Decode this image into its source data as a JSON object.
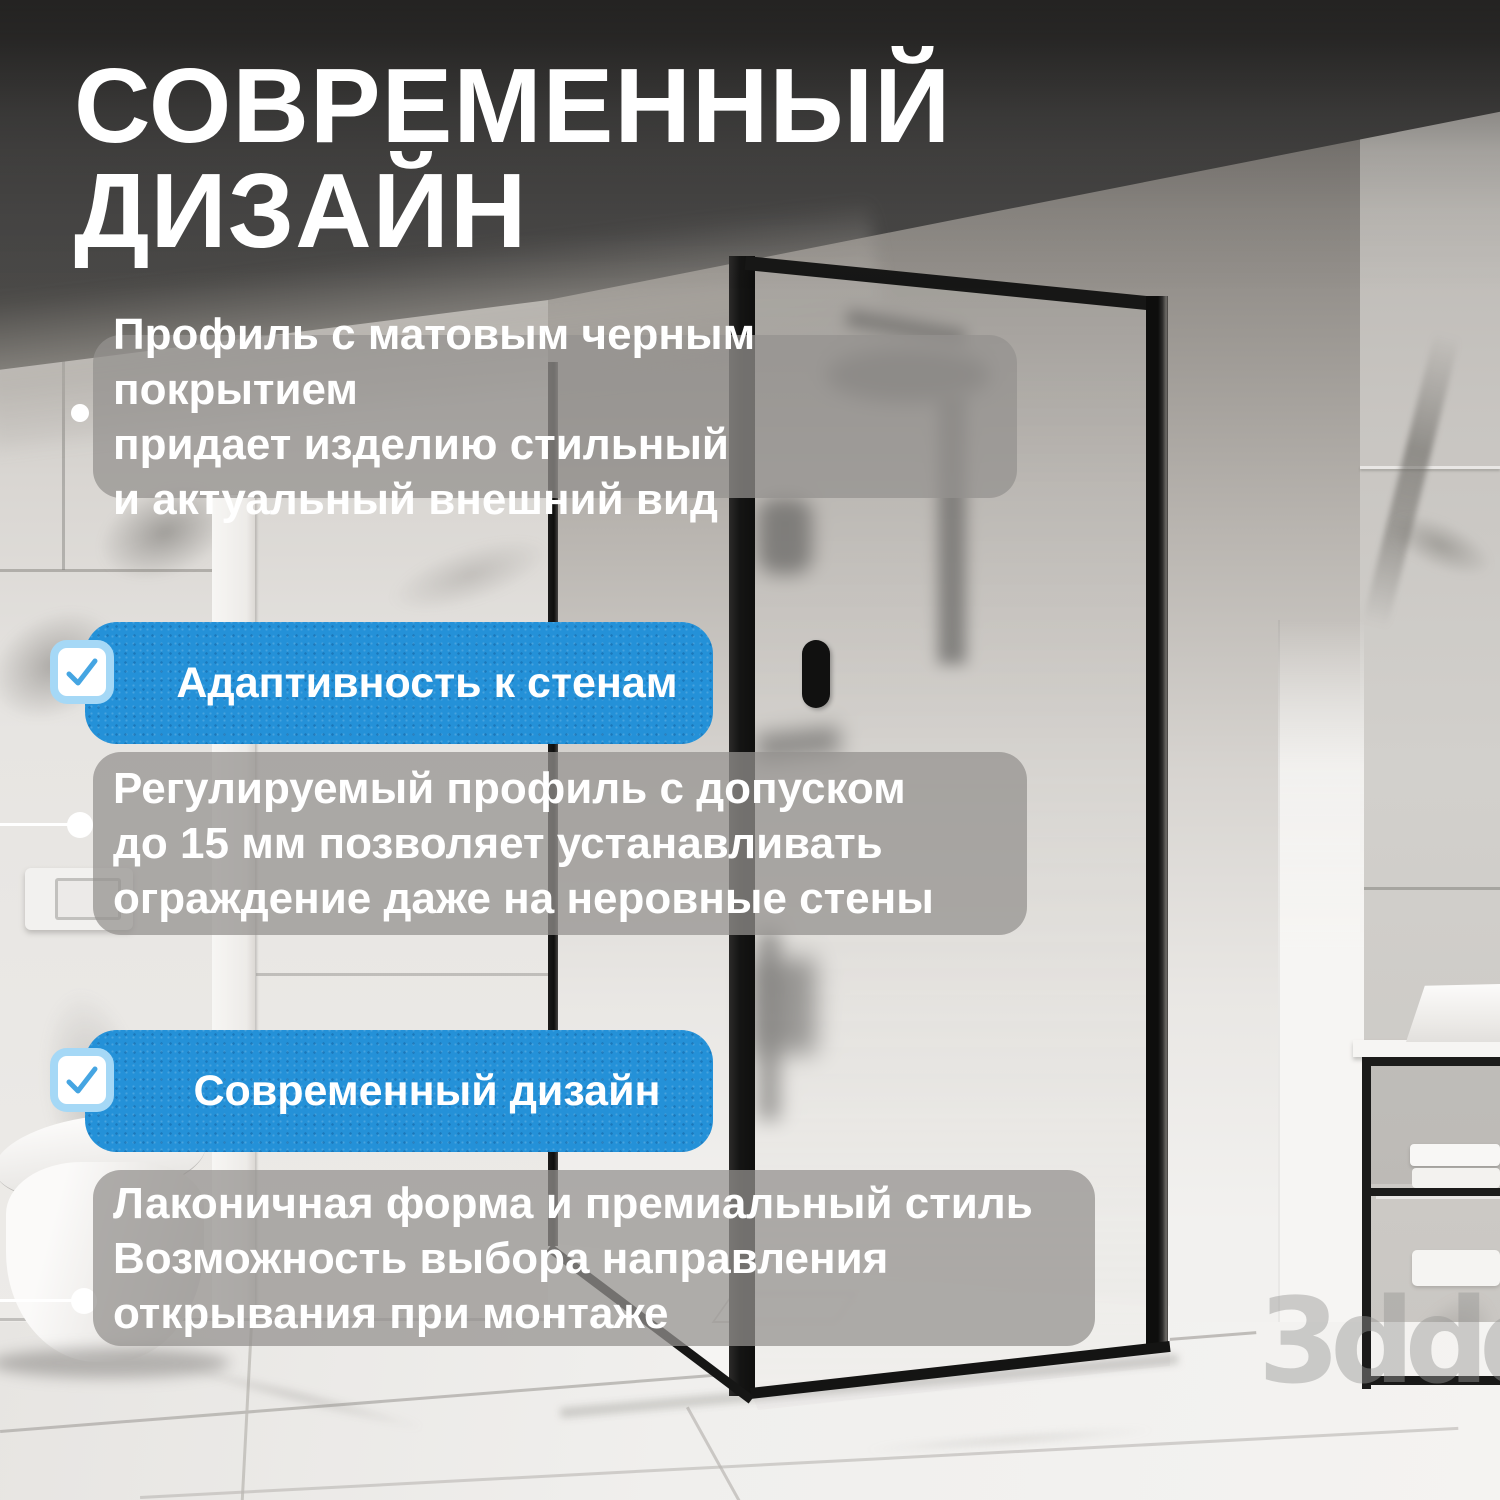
{
  "title": {
    "line1": "СОВРЕМЕННЫЙ",
    "line2": "ДИЗАЙН"
  },
  "features": [
    {
      "lines": [
        "Профиль с матовым черным покрытием",
        "придает изделию стильный",
        "и актуальный внешний вид"
      ]
    },
    {
      "lines": [
        "Регулируемый профиль с допуском",
        "до 15 мм позволяет устанавливать",
        "ограждение даже на неровные стены"
      ]
    },
    {
      "lines": [
        "Лаконичная форма и премиальный стиль",
        "Возможность выбора направления",
        "открывания при монтаже"
      ]
    }
  ],
  "badges": [
    {
      "label": "Адаптивность к стенам",
      "icon": "checkbox-check-icon"
    },
    {
      "label": "Современный дизайн",
      "icon": "checkbox-check-icon"
    }
  ],
  "watermark": "3ddd",
  "colors": {
    "accent_blue": "#2491d8",
    "checkbox_ring": "#a5d8f6",
    "checkbox_check": "#45a5e2",
    "panel_gray": "rgba(148,146,143,0.74)",
    "text_white": "#ffffff",
    "frame_black": "#171716"
  }
}
